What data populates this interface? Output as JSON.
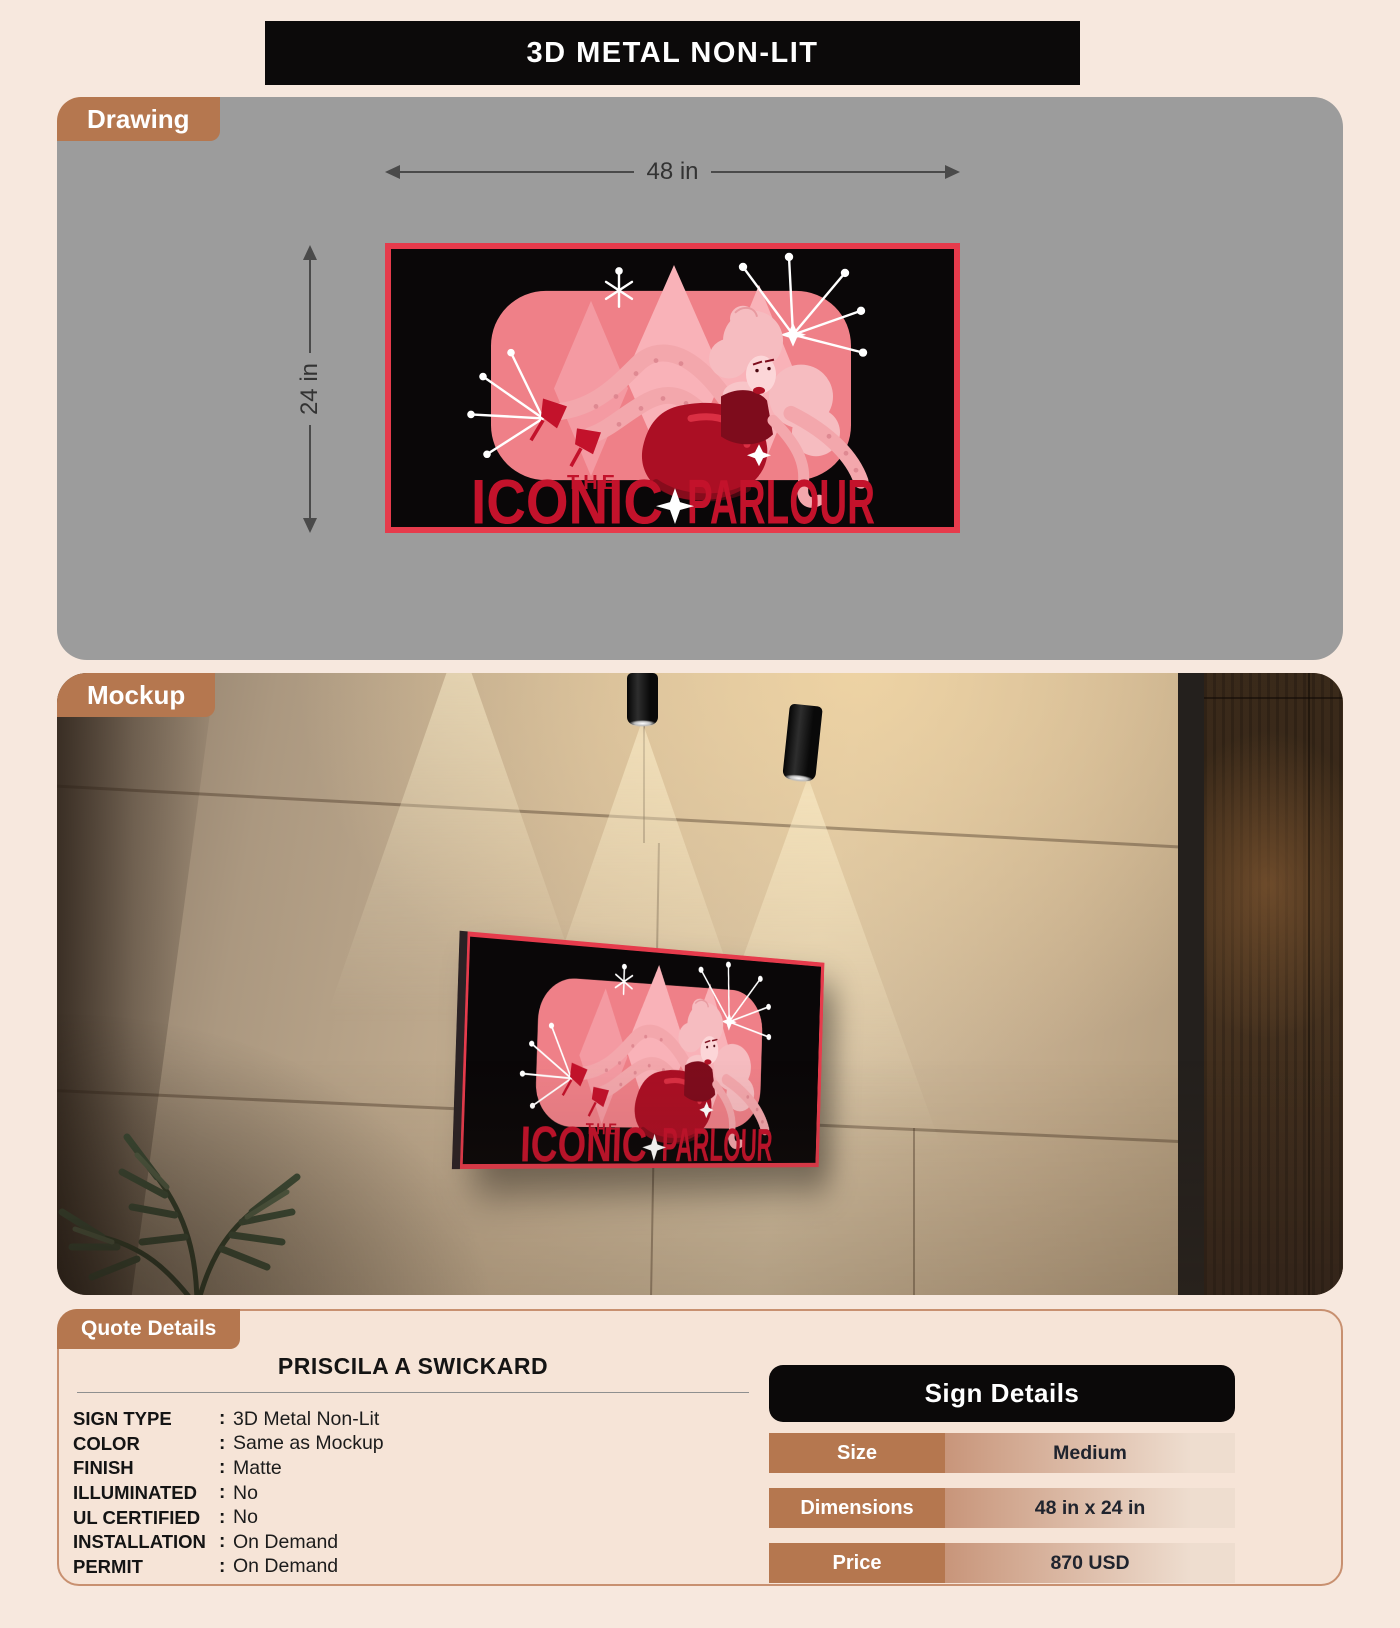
{
  "banner": {
    "title": "3D METAL NON-LIT"
  },
  "drawing": {
    "tab_label": "Drawing",
    "width_label": "48 in",
    "height_label": "24 in",
    "sign_art": {
      "the": "THE",
      "iconic": "ICONIC",
      "parlour": "PARLOUR"
    }
  },
  "mockup": {
    "tab_label": "Mockup"
  },
  "quote": {
    "tab_label": "Quote Details",
    "customer_name": "PRISCILA A SWICKARD",
    "colon": ":",
    "specs": [
      {
        "label": "SIGN TYPE",
        "value": "3D Metal Non-Lit"
      },
      {
        "label": "COLOR",
        "value": "Same as Mockup"
      },
      {
        "label": "FINISH",
        "value": "Matte"
      },
      {
        "label": "ILLUMINATED",
        "value": "No"
      },
      {
        "label": "UL CERTIFIED",
        "value": "No"
      },
      {
        "label": "INSTALLATION",
        "value": "On Demand"
      },
      {
        "label": "PERMIT",
        "value": "On Demand"
      }
    ]
  },
  "sign_details": {
    "title": "Sign Details",
    "rows": [
      {
        "label": "Size",
        "value": "Medium"
      },
      {
        "label": "Dimensions",
        "value": "48 in x 24 in"
      },
      {
        "label": "Price",
        "value": "870 USD"
      }
    ]
  },
  "colors": {
    "page_bg": "#f7e8de",
    "accent_copper": "#b5774f",
    "panel_gray": "#9c9c9c",
    "banner_black": "#0c0a0a",
    "sign_border_red": "#e63b4c",
    "artwork_red": "#c3122b",
    "artwork_pink": "#ef8088",
    "quote_panel_bg": "#f6e4d7"
  }
}
